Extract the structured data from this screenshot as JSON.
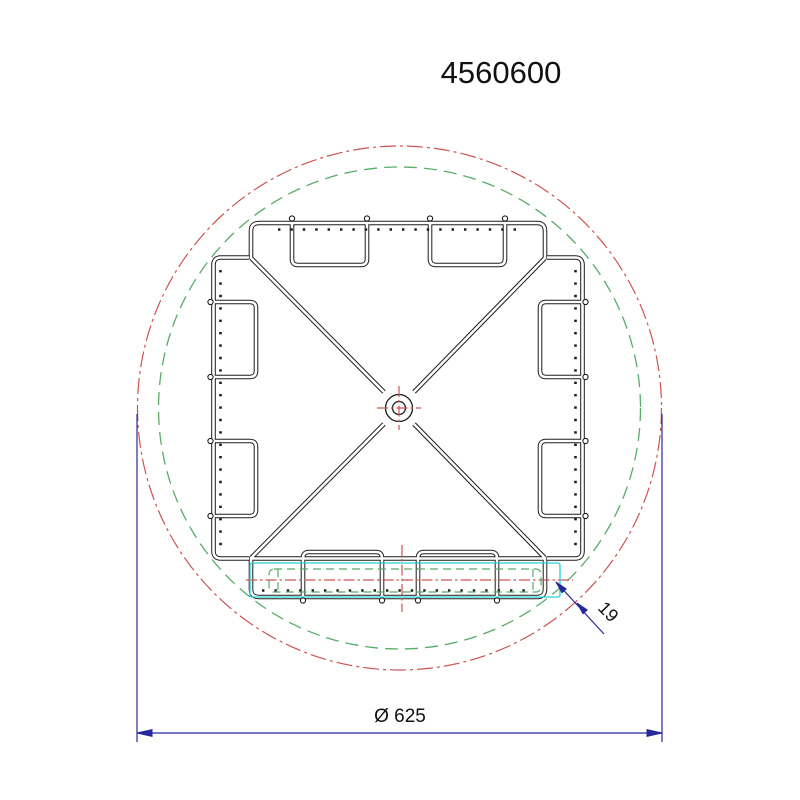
{
  "drawing": {
    "title": "4560600",
    "diameter_label": "Ø 625",
    "thickness_label": "19",
    "colors": {
      "outline_black": "#1c1c1c",
      "centerline_red": "#cd5353",
      "hidden_green": "#57ac68",
      "highlight_cyan": "#27d1d4",
      "dimension_blue": "#28289a"
    }
  }
}
